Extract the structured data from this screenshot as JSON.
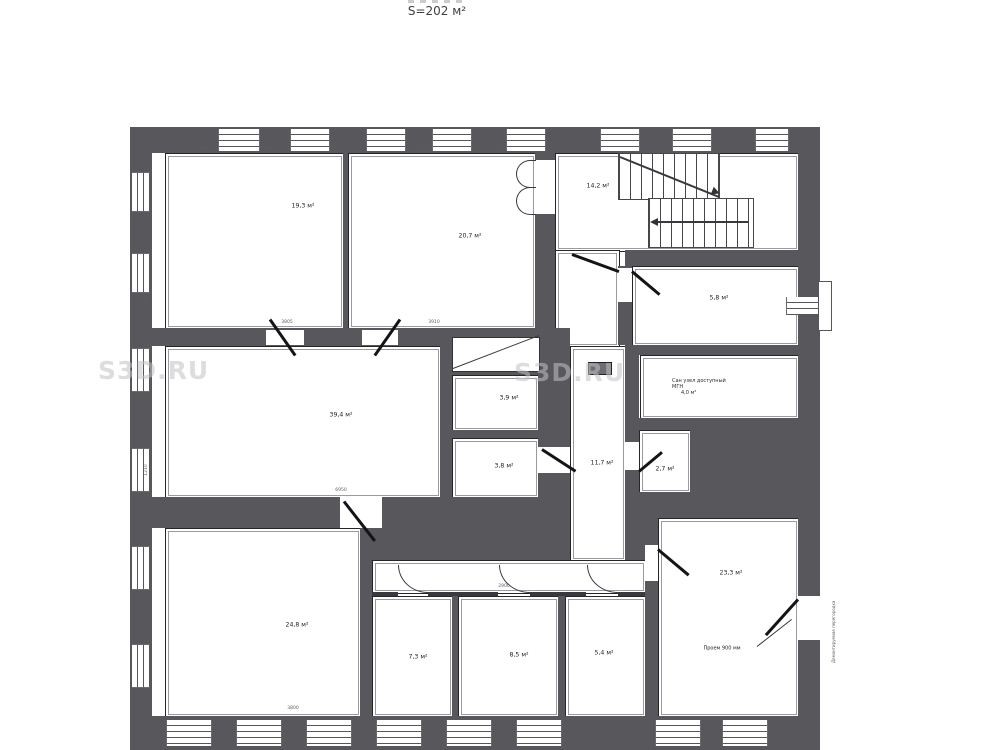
{
  "title": "S=202 м²",
  "watermark": "S3D.RU",
  "rooms": {
    "top_left": {
      "label": "19,3 м²"
    },
    "top_mid": {
      "label": "20,7 м²"
    },
    "stair_hall": {
      "label": "14,2 м²"
    },
    "room_58": {
      "label": "5,8 м²"
    },
    "san_uzel": {
      "line1": "Сан узел доступный",
      "line2": "МГН",
      "line3": "4,0 м²"
    },
    "corridor": {
      "label": "11,7 м²"
    },
    "room_27": {
      "label": "2,7 м²"
    },
    "room_233": {
      "label": "23,3 м²"
    },
    "room_39": {
      "label": "3,9 м²"
    },
    "room_38": {
      "label": "3,8 м²"
    },
    "hall_big": {
      "label": "39,4 м²"
    },
    "bottom_left": {
      "label": "24,8 м²"
    },
    "room_73": {
      "label": "7,3 м²"
    },
    "room_85": {
      "label": "8,5 м²"
    },
    "room_54": {
      "label": "5,4 м²"
    }
  },
  "annotations": {
    "doorway": "Проем 900 мм",
    "side_note": "Демонтируемая перегородка"
  },
  "dims": [
    "900",
    "1490",
    "910",
    "1500",
    "950",
    "3805",
    "3910",
    "6950",
    "3800",
    "2900",
    "1500",
    "1210"
  ],
  "colors": {
    "wall": "#58585c",
    "line": "#26262a",
    "watermark": "#c3c3c7"
  }
}
